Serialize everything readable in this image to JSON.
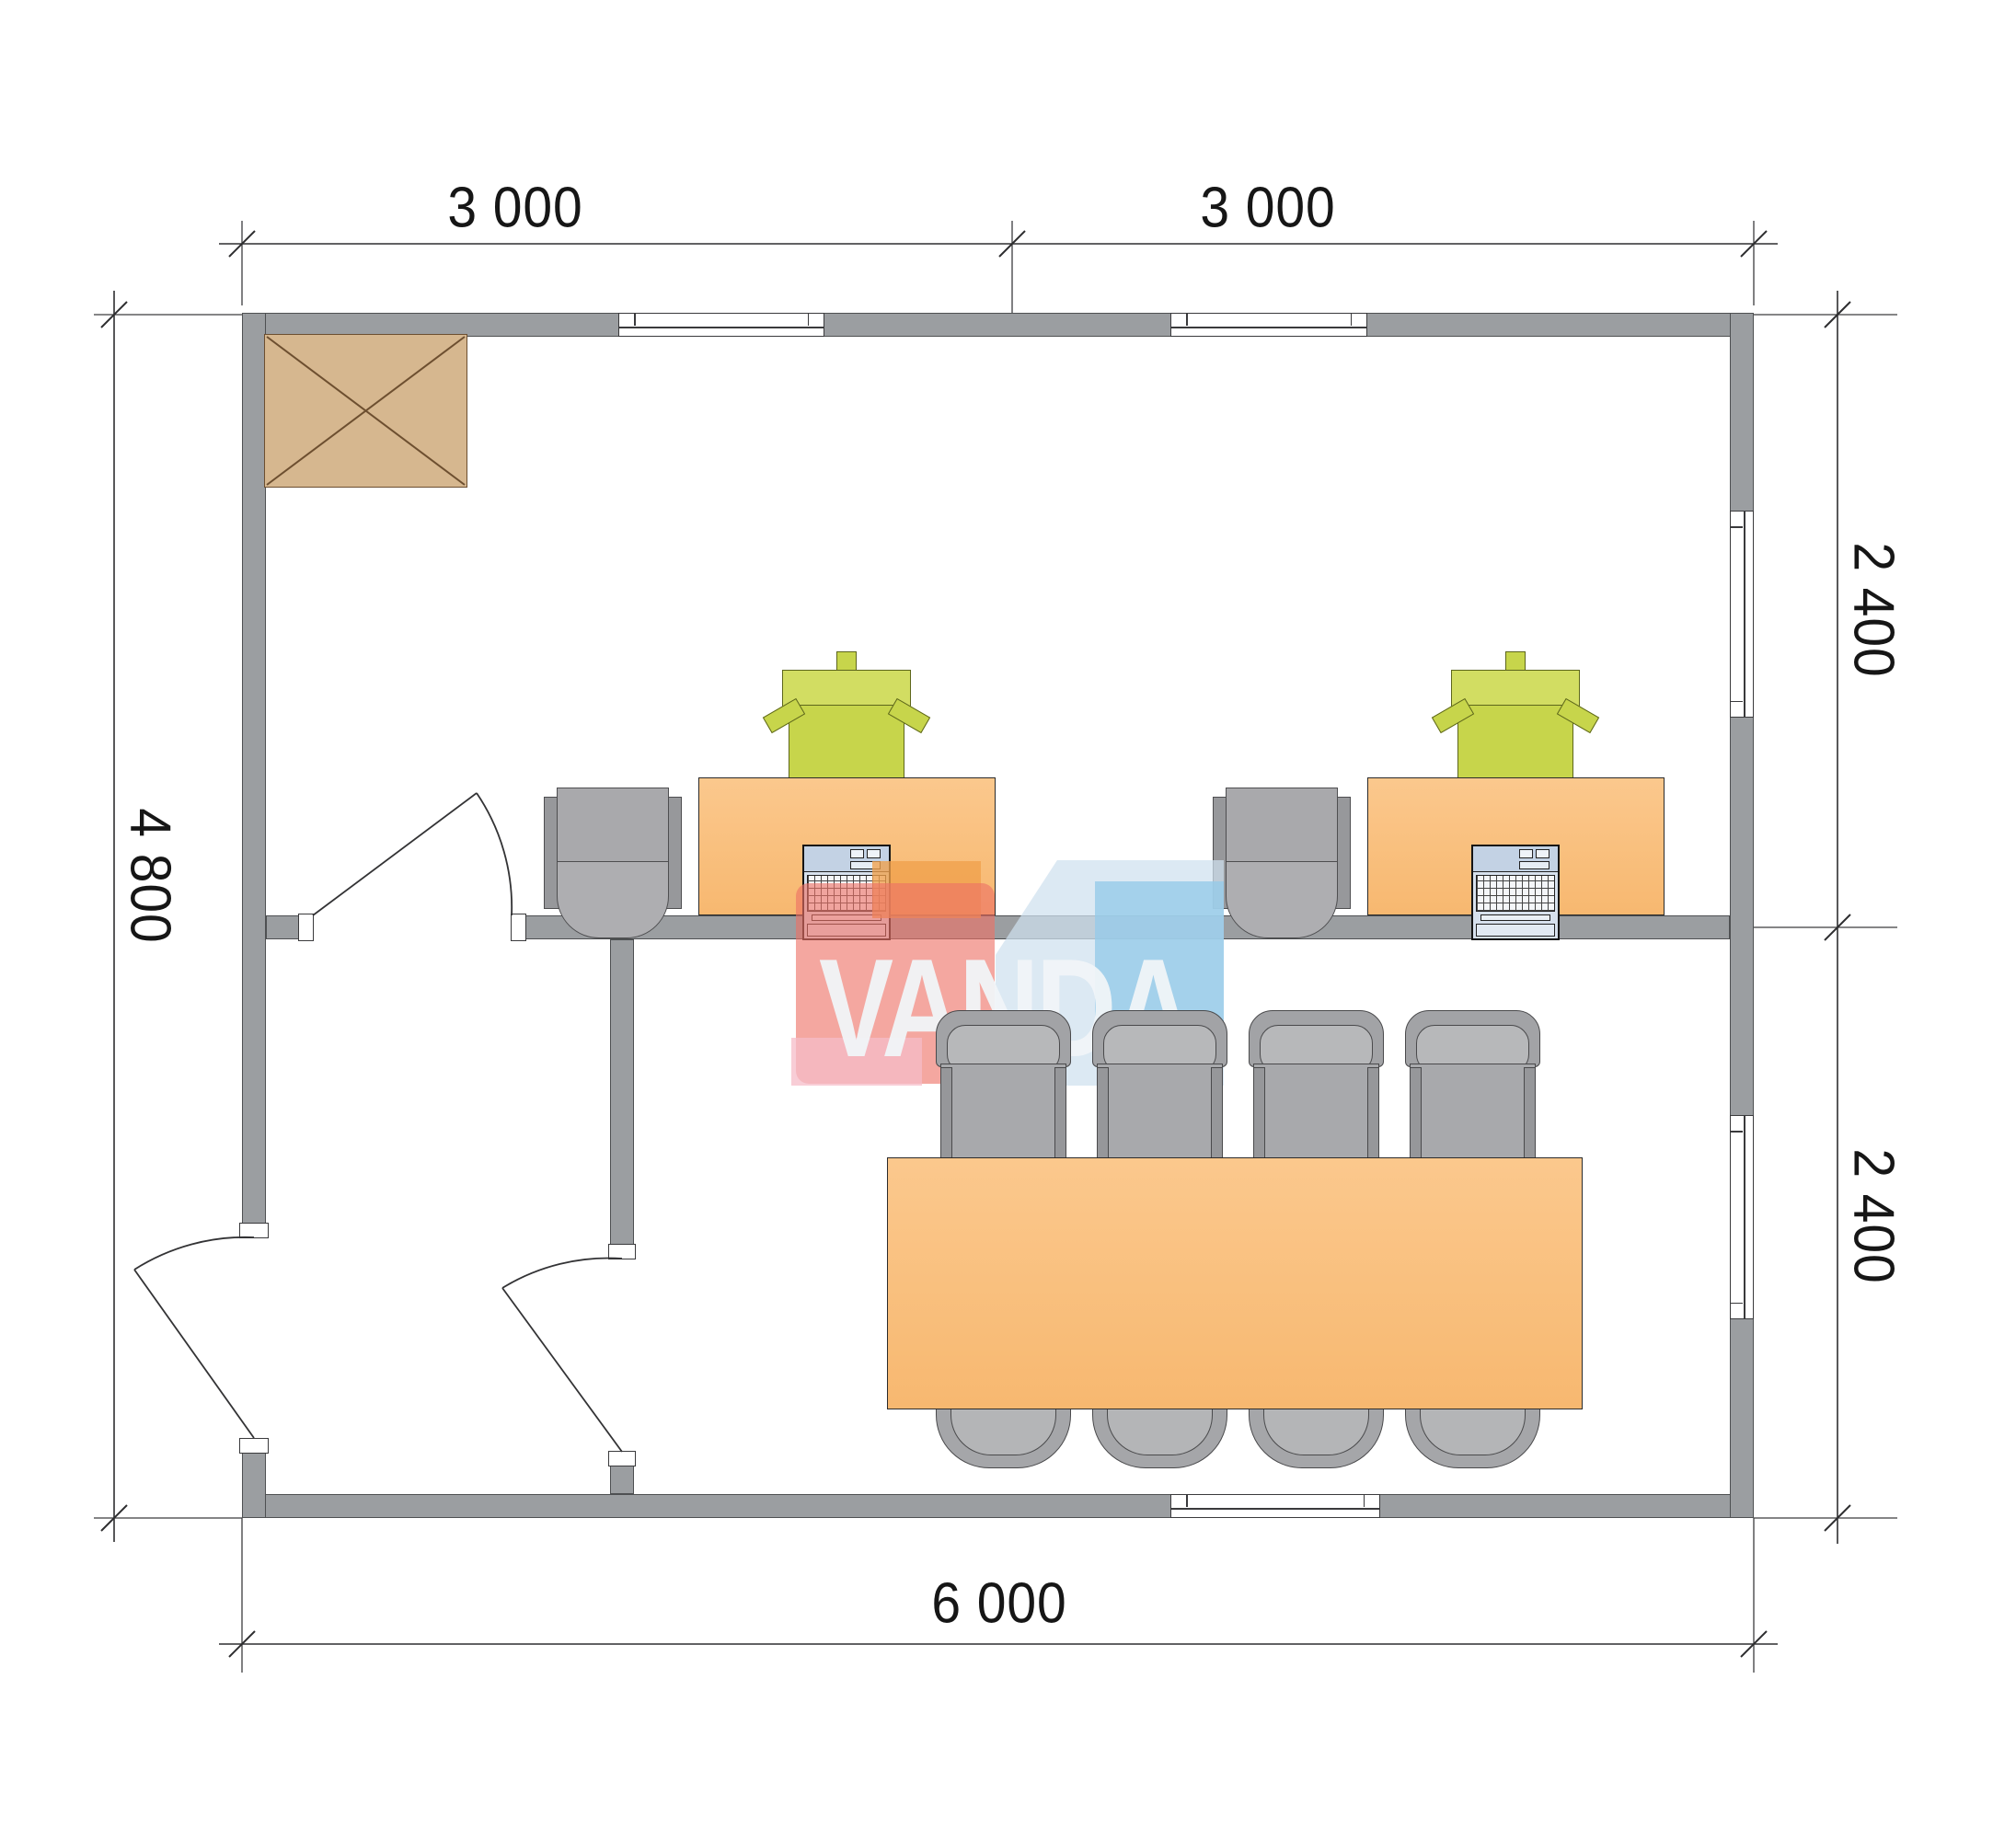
{
  "document": {
    "title": "Office floor plan",
    "type": "architectural-floor-plan",
    "units": "mm"
  },
  "dimensions": {
    "top": [
      "3 000",
      "3 000"
    ],
    "right": [
      "2 400",
      "2 400"
    ],
    "left": [
      "4 800"
    ],
    "bottom": [
      "6 000"
    ]
  },
  "watermark": {
    "text": "VANDA"
  },
  "layout": {
    "overall_width_mm": 6000,
    "overall_depth_mm": 4800,
    "rooms": [
      {
        "name": "office",
        "furniture": [
          "desk",
          "desk",
          "green-task-chair",
          "green-task-chair",
          "gray-side-chair",
          "gray-side-chair",
          "laptop",
          "laptop",
          "storage-cabinet"
        ]
      },
      {
        "name": "meeting-room",
        "furniture": [
          "conference-table",
          "chair",
          "chair",
          "chair",
          "chair",
          "chair",
          "chair",
          "chair",
          "chair"
        ]
      }
    ],
    "windows": 5,
    "doors": 3
  },
  "colors": {
    "wall": "#9b9ea1",
    "dimension_text": "#161616",
    "desk": "#f9c183",
    "table": "#f9c183",
    "chair_green": "#c7d54b",
    "chair_gray": "#a8a9ac",
    "cabinet": "#d6b78f",
    "laptop": "#d7e1ed",
    "logo_red": "#ee7166",
    "logo_orange": "#f0a04b",
    "logo_pink": "#f6bcc8",
    "logo_blue_light": "#cfe0ef",
    "logo_blue": "#96cbe9"
  }
}
